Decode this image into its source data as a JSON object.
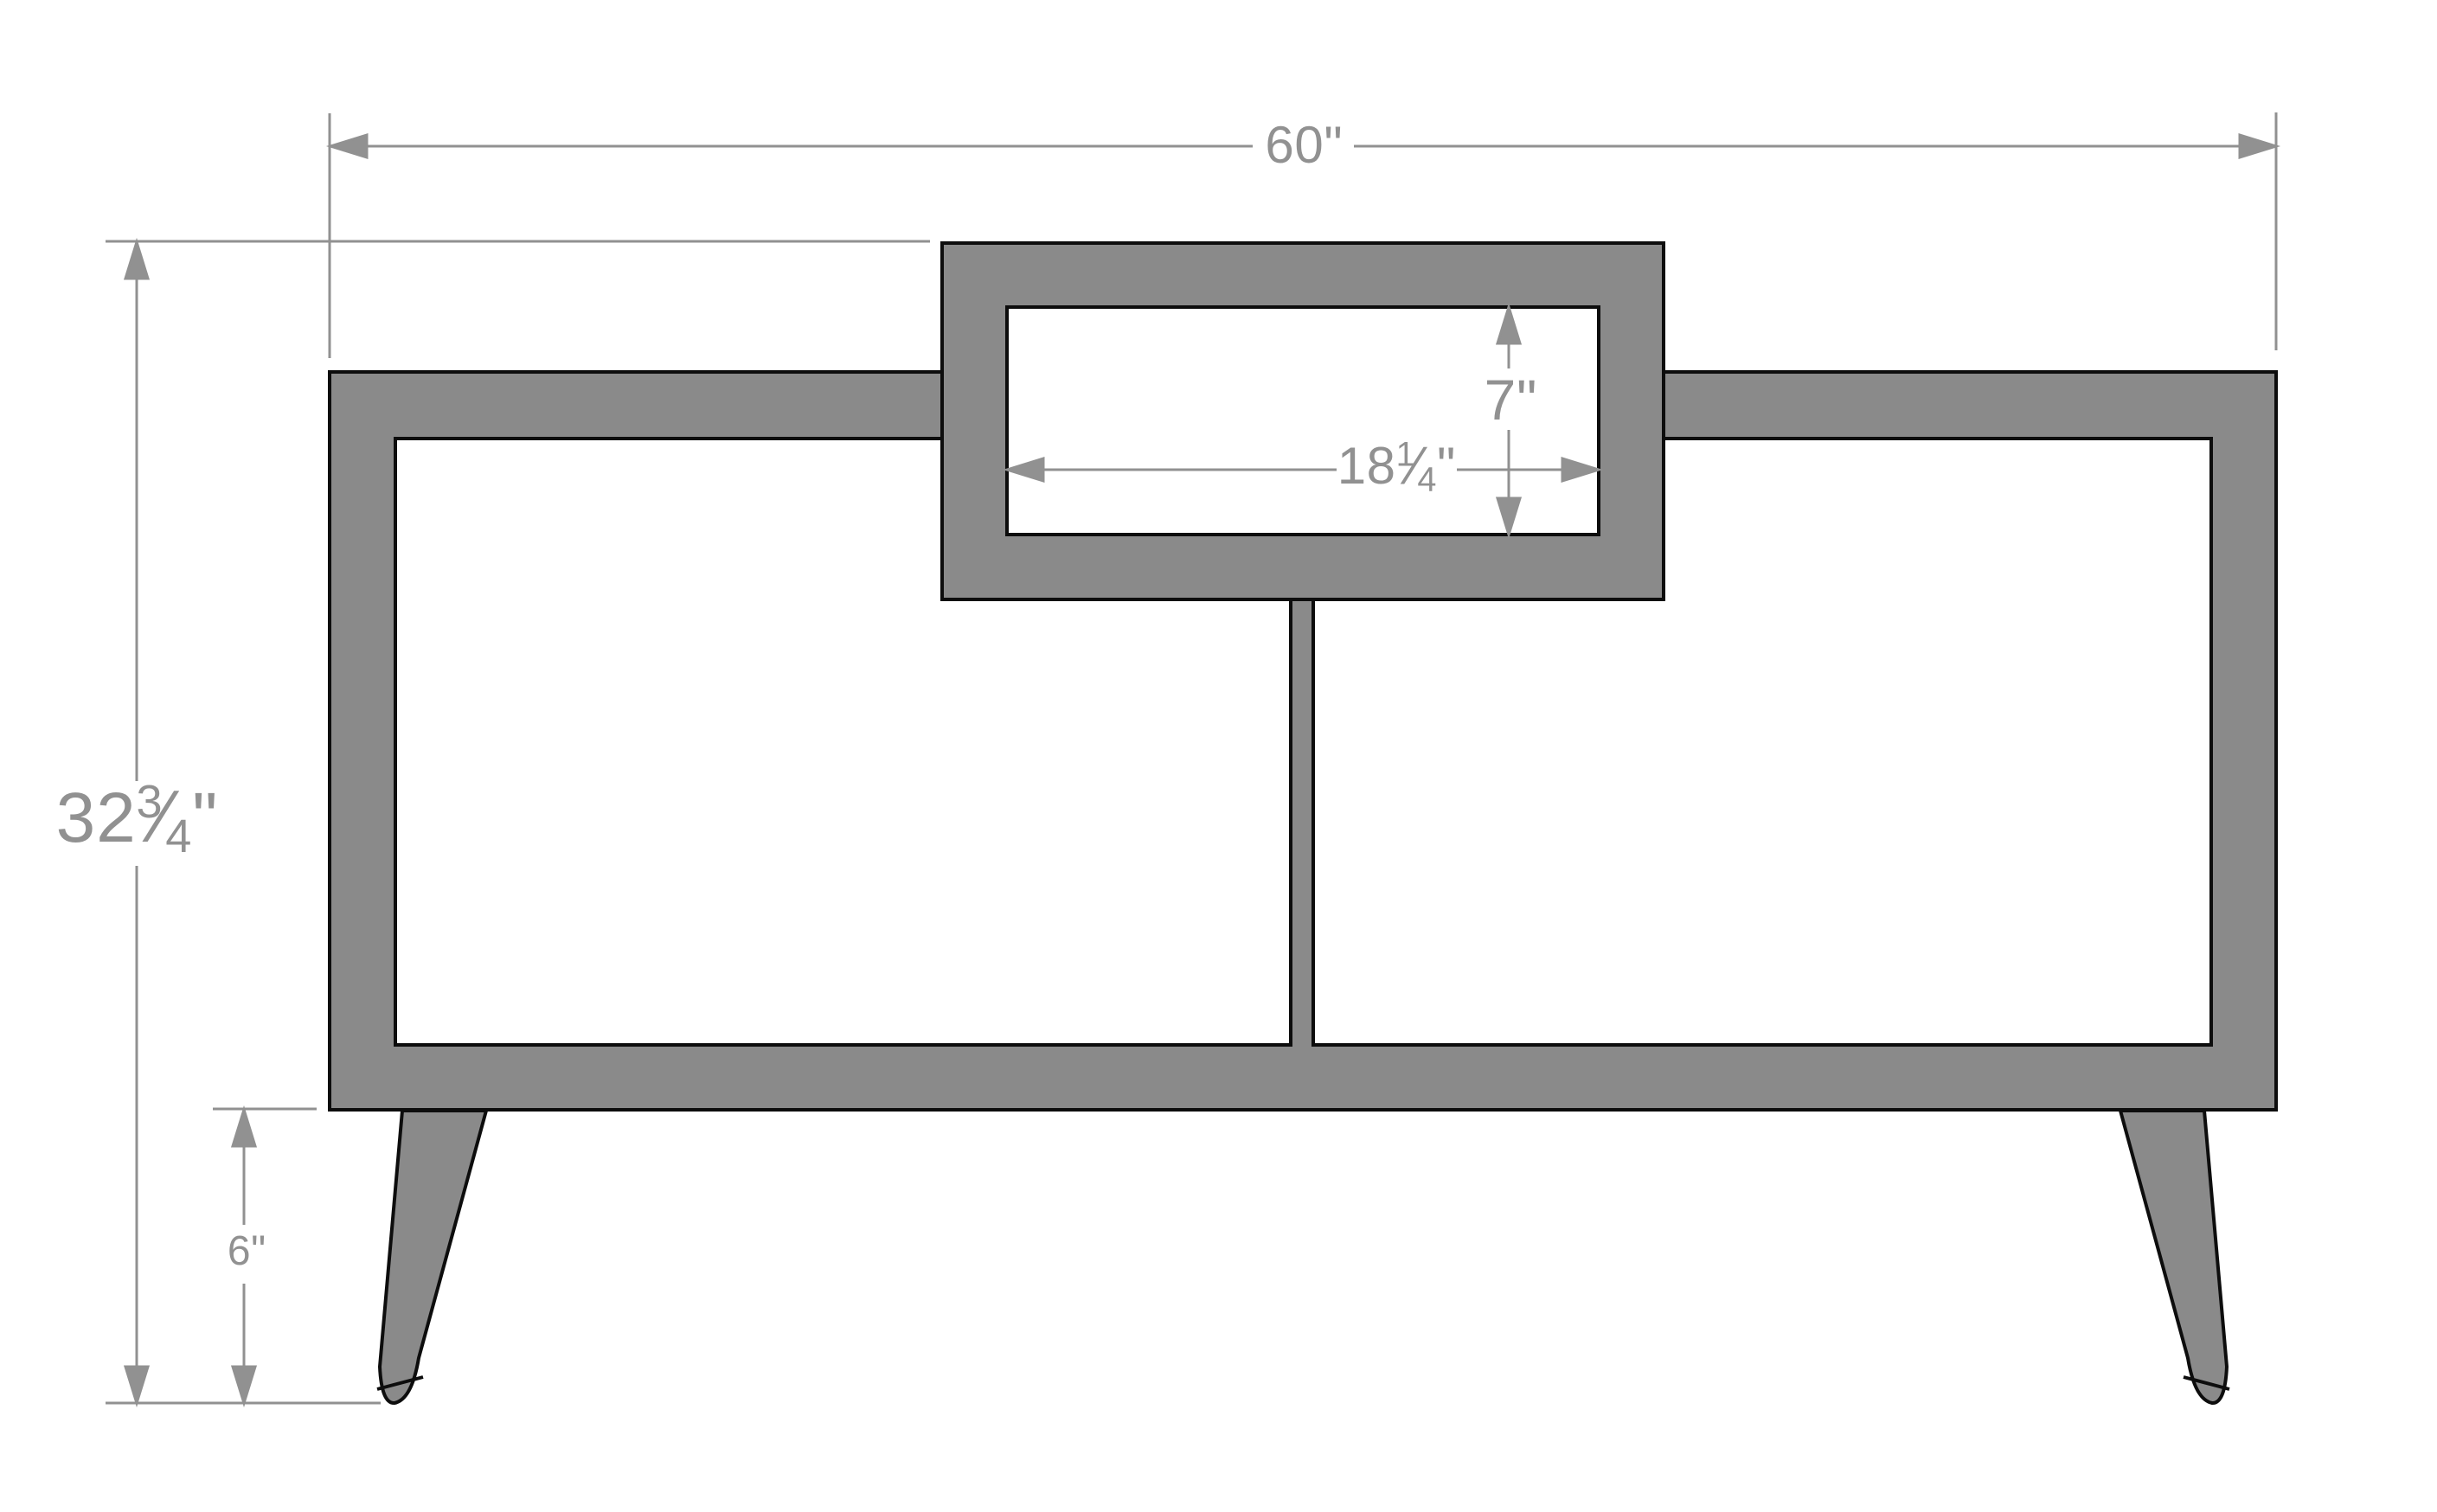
{
  "drawing": {
    "type": "furniture-dimension-diagram",
    "subject": "console cabinet front elevation with raised top cubby and splayed legs",
    "units": "inches",
    "dimensions": {
      "overall_width": {
        "label": "60\"",
        "whole": "60",
        "unit": "\""
      },
      "overall_height": {
        "label": "32 3/4\"",
        "whole": "32",
        "frac_num": "3",
        "frac_den": "4",
        "frac_slash": "⁄",
        "unit": "\""
      },
      "cubby_width": {
        "label": "18 1/4\"",
        "whole": "18",
        "frac_num": "1",
        "frac_den": "4",
        "frac_slash": "⁄",
        "unit": "\""
      },
      "cubby_height": {
        "label": "7\"",
        "whole": "7",
        "unit": "\""
      },
      "leg_height": {
        "label": "6\"",
        "whole": "6",
        "unit": "\""
      }
    },
    "colors": {
      "body": "#8a8a8a",
      "outline": "#0d0d0d",
      "dimension": "#919191",
      "background": "#ffffff"
    }
  }
}
